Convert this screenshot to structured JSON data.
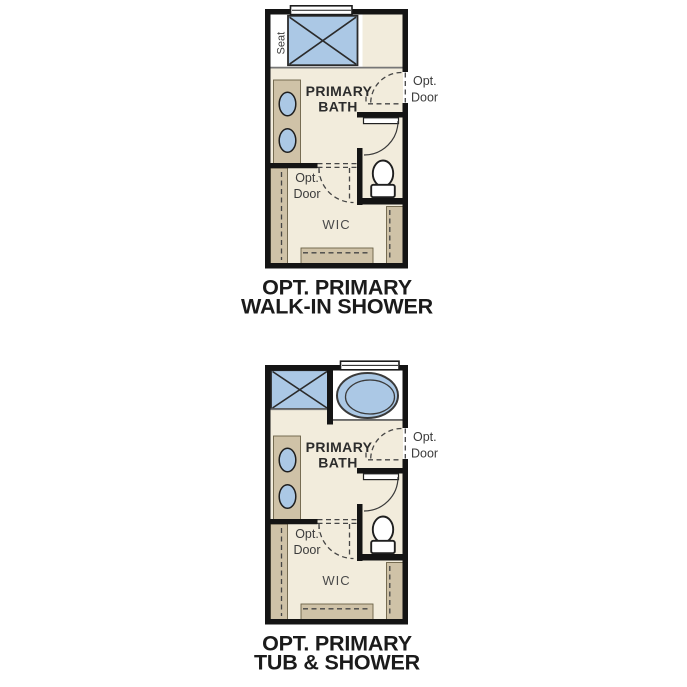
{
  "figure_type": "floor-plan-option-diagrams",
  "colors": {
    "background": "#ffffff",
    "floor": "#f2ecdc",
    "wall": "#141414",
    "fixture_blue": "#abc8e5",
    "cabinet_tan": "#cfc2a7",
    "caption_text": "#1b1b1b"
  },
  "plans": [
    {
      "caption1": "OPT. PRIMARY",
      "caption2": "WALK-IN SHOWER",
      "room_label1": "PRIMARY",
      "room_label2": "BATH",
      "seat_label": "Seat",
      "wic_label": "WIC",
      "opt_door_bath1": "Opt.",
      "opt_door_bath2": "Door",
      "opt_door_wic1": "Opt.",
      "opt_door_wic2": "Door"
    },
    {
      "caption1": "OPT. PRIMARY",
      "caption2": "TUB & SHOWER",
      "room_label1": "PRIMARY",
      "room_label2": "BATH",
      "wic_label": "WIC",
      "opt_door_bath1": "Opt.",
      "opt_door_bath2": "Door",
      "opt_door_wic1": "Opt.",
      "opt_door_wic2": "Door"
    }
  ]
}
